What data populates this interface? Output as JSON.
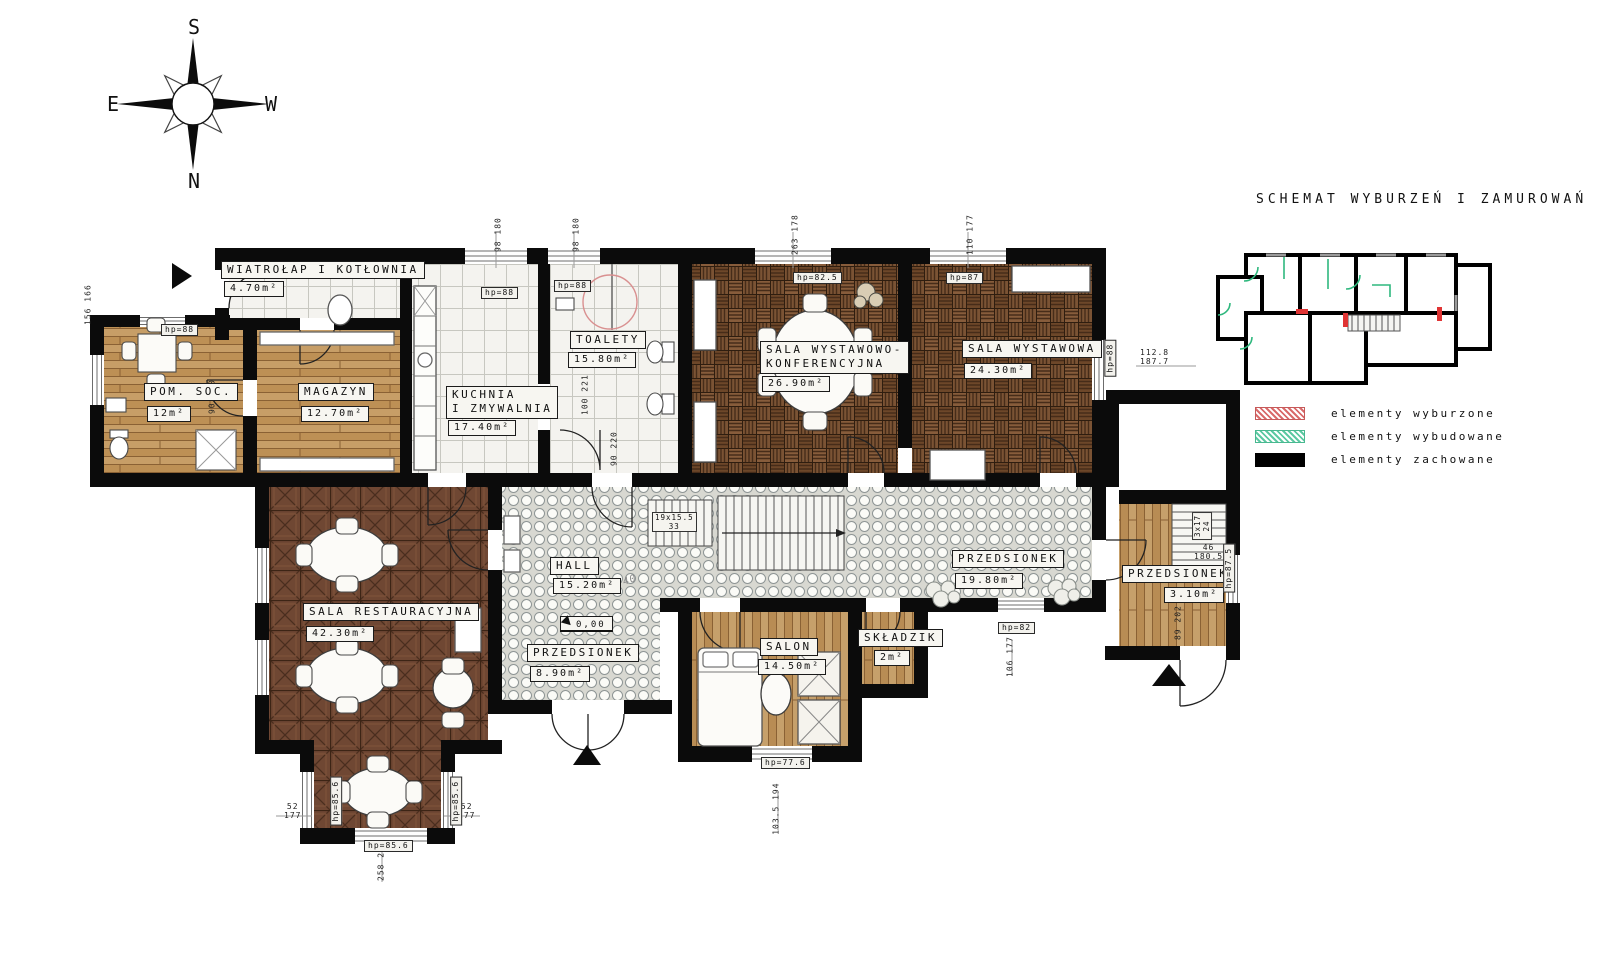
{
  "title": "SCHEMAT WYBURZEŃ I ZAMUROWAŃ",
  "compass": {
    "top": "S",
    "bottom": "N",
    "left": "E",
    "right": "W"
  },
  "legend": {
    "items": [
      {
        "label": "elementy wyburzone",
        "style": "hatch-red",
        "color": "#d96a6a"
      },
      {
        "label": "elementy wybudowane",
        "style": "hatch-green",
        "color": "#5cc9a2"
      },
      {
        "label": "elementy zachowane",
        "style": "solid-black",
        "color": "#000000"
      }
    ]
  },
  "rooms": [
    {
      "name": "WIATROŁAP I KOTŁOWNIA",
      "area": "4.70m²"
    },
    {
      "name": "POM. SOC.",
      "area": "12m²"
    },
    {
      "name": "MAGAZYN",
      "area": "12.70m²"
    },
    {
      "name": "KUCHNIA\nI ZMYWALNIA",
      "area": "17.40m²"
    },
    {
      "name": "TOALETY",
      "area": "15.80m²"
    },
    {
      "name": "SALA WYSTAWOWO-\nKONFERENCYJNA",
      "area": "26.90m²"
    },
    {
      "name": "SALA WYSTAWOWA",
      "area": "24.30m²"
    },
    {
      "name": "SALA RESTAURACYJNA",
      "area": "42.30m²"
    },
    {
      "name": "HALL",
      "area": "15.20m²"
    },
    {
      "name": "PRZEDSIONEK",
      "area": "8.90m²"
    },
    {
      "name": "SALON",
      "area": "14.50m²"
    },
    {
      "name": "SKŁADZIK",
      "area": "2m²"
    },
    {
      "name": "PRZEDSIONEK",
      "area": "19.80m²"
    },
    {
      "name": "PRZEDSIONEK",
      "area": "3.10m²"
    }
  ],
  "annotations": {
    "level_marker": "0,00",
    "hall_note": "+40",
    "stairs_main": "19x15.5\n33",
    "stairs_side": "3x17\n24",
    "dims": [
      "98 180",
      "98 180",
      "263 178",
      "110 177",
      "156 166",
      "90 220",
      "100 221",
      "90 220",
      "112.8\n187.7",
      "52\n177",
      "52\n177",
      "258 208",
      "103.5 194",
      "106 177",
      "46\n180.5",
      "89 202"
    ],
    "hp": [
      "hp=88",
      "hp=88",
      "hp=88",
      "hp=82.5",
      "hp=87",
      "hp=88",
      "hp=85.6",
      "hp=85.6",
      "hp=85.6",
      "hp=77.6",
      "hp=82",
      "hp=87.5"
    ]
  }
}
